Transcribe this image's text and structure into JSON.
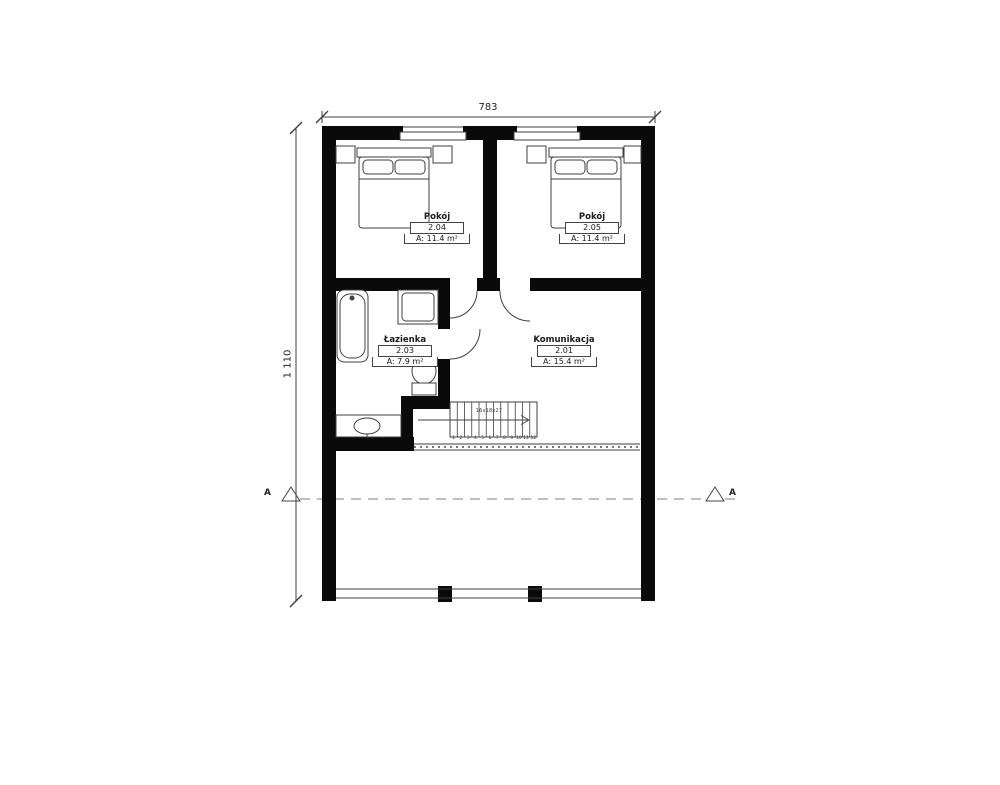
{
  "plan": {
    "dimensions": {
      "width_top": "783",
      "height_left": "1 110"
    },
    "section_marker": {
      "left": "A",
      "right": "A"
    },
    "rooms": [
      {
        "name": "Pokój",
        "number": "2.04",
        "area": "A: 11.4 m²"
      },
      {
        "name": "Pokój",
        "number": "2.05",
        "area": "A: 11.4 m²"
      },
      {
        "name": "Łazienka",
        "number": "2.03",
        "area": "A: 7.9 m²"
      },
      {
        "name": "Komunikacja",
        "number": "2.01",
        "area": "A: 15.4 m²"
      }
    ],
    "stairs": {
      "dimension_label": "16x18x27",
      "tread_count": 12,
      "step_numbers": [
        "1",
        "2",
        "3",
        "4",
        "5",
        "6",
        "7",
        "8",
        "9",
        "10",
        "11",
        "12"
      ]
    },
    "fixtures": [
      "bathtub",
      "shower",
      "toilet",
      "sink",
      "double-bed",
      "double-bed",
      "nightstands"
    ],
    "colors": {
      "wall": "#0a0a0a",
      "line": "#3f3f3f",
      "dashed_section": "#9a9a9a",
      "background": "#ffffff"
    }
  }
}
